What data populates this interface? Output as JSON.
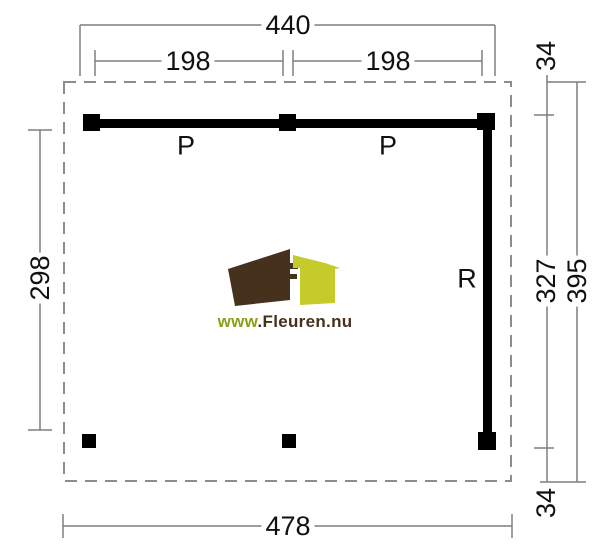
{
  "drawing": {
    "beam_labels": {
      "top_left": "P",
      "top_right": "P",
      "right": "R"
    },
    "dimensions": {
      "top_total": "440",
      "top_bay_left": "198",
      "top_bay_right": "198",
      "overhang_top_right": "34",
      "side_left": "298",
      "side_inner_right": "327",
      "side_total_right": "395",
      "overhang_bottom_right": "34",
      "bottom_total": "478"
    }
  },
  "logo": {
    "url_www": "www",
    "url_domain": ".Fleuren.nu",
    "house_brown": "#46311D",
    "house_yellow_green": "#C5CB2B",
    "www_text_color": "#8D9E1A"
  },
  "style_colors": {
    "beam": "#000000",
    "dimension_line": "#7F7F7F",
    "dashed_outline": "#8C8C8C",
    "label_text": "#111111",
    "background": "#FFFFFF"
  }
}
